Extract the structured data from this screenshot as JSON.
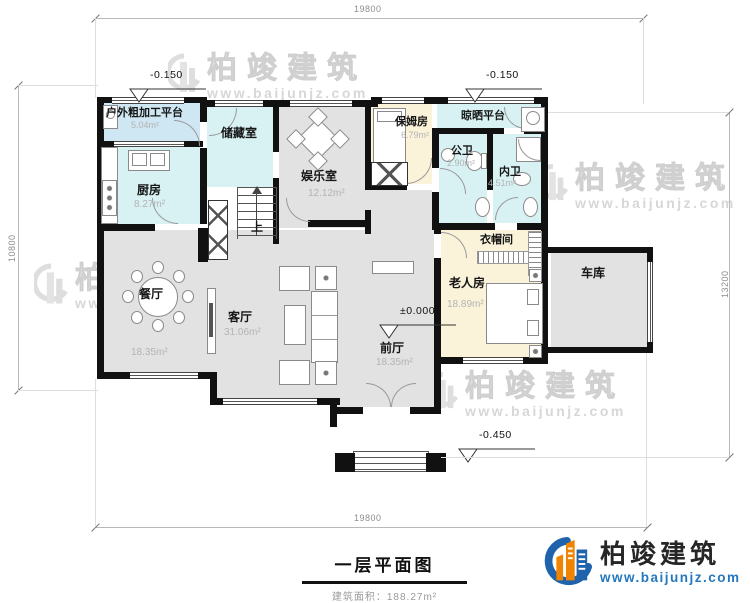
{
  "plan": {
    "title": "一层平面图",
    "area_note": "建筑面积：188.27m²"
  },
  "dimensions": {
    "top": "19800",
    "bottom": "19800",
    "left": "10800",
    "right": "13200"
  },
  "elevations": {
    "top_left": "-0.150",
    "top_right": "-0.150",
    "main": "±0.000",
    "entrance": "-0.450"
  },
  "rooms": {
    "outdoor_platform": {
      "name": "户外粗加工平台",
      "area": "5.04m²"
    },
    "kitchen": {
      "name": "厨房",
      "area": "8.27m²"
    },
    "storage": {
      "name": "储藏室"
    },
    "game_room": {
      "name": "娱乐室",
      "area": "12.12m²"
    },
    "nanny_room": {
      "name": "保姆房",
      "area": "6.79m²"
    },
    "drying_platform": {
      "name": "晾晒平台"
    },
    "public_bath": {
      "name": "公卫",
      "area": "2.90m²"
    },
    "private_bath": {
      "name": "内卫",
      "area": "4.51m²"
    },
    "cloakroom": {
      "name": "衣帽间"
    },
    "elder_room": {
      "name": "老人房",
      "area": "18.89m²"
    },
    "garage": {
      "name": "车库"
    },
    "dining": {
      "name": "餐厅",
      "area": "18.35m²"
    },
    "living": {
      "name": "客厅",
      "area": "31.06m²"
    },
    "front_hall": {
      "name": "前厅",
      "area": "18.35m²"
    },
    "stairs": {
      "name": "上"
    }
  },
  "watermark": {
    "text": "柏竣建筑",
    "url": "www.baijunjz.com"
  },
  "logo": {
    "name": "柏竣建筑",
    "url": "www.baijunjz.com"
  },
  "colors": {
    "wall": "#111111",
    "room_gray": "#e2e2e2",
    "room_cyan": "#d8f2f4",
    "room_blue": "#cfe7f2",
    "room_cream": "#faf3da",
    "logo_blue": "#1f63ad",
    "logo_orange": "#f08300",
    "url_blue": "#2478be"
  }
}
